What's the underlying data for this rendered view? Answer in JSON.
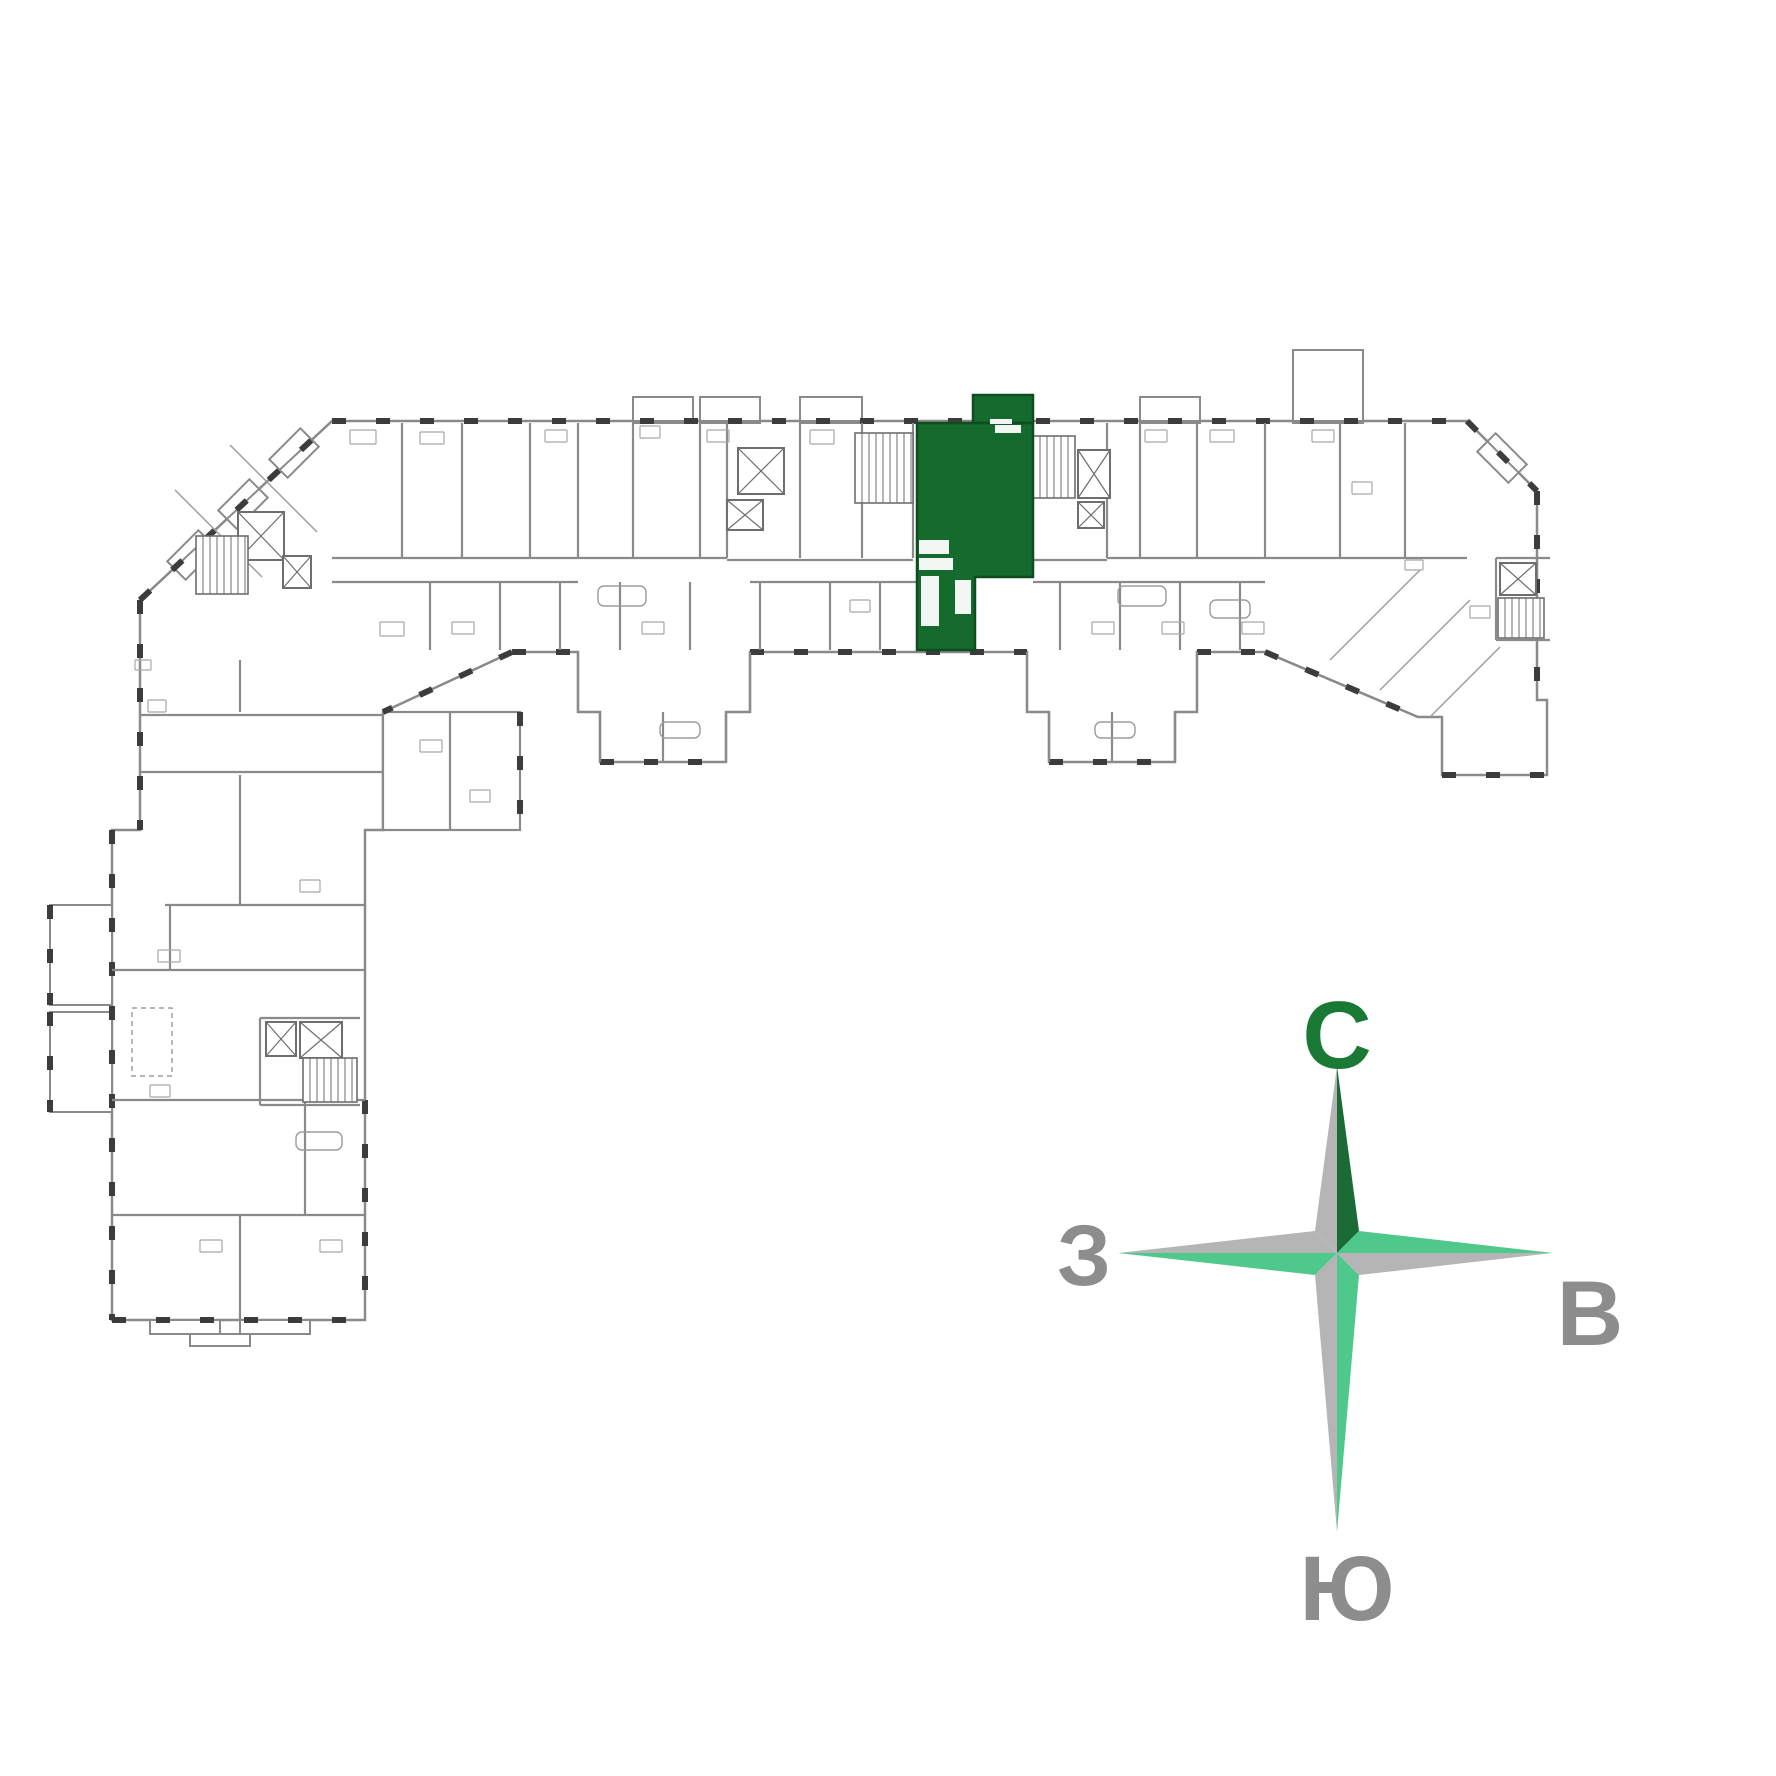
{
  "canvas": {
    "w": 1776,
    "h": 1776,
    "bg": "#ffffff"
  },
  "palette": {
    "wall": "#8a8a8a",
    "wall_dark": "#3c3c3c",
    "wall_mid": "#6e6e6e",
    "thin": "#9b9b9b",
    "fixture": "#a8a8a8",
    "green": "#156b2e",
    "green_stroke": "#0d4d20",
    "arm_gray": "#b5b5b5",
    "arm_green_dark": "#1a6b35",
    "arm_green_light": "#4fc98b",
    "text_gray": "#8d8d8d",
    "text_green": "#1a7a35"
  },
  "floorplan": {
    "outline": [
      [
        332,
        421
      ],
      [
        1467,
        421
      ],
      [
        1537,
        491
      ],
      [
        1537,
        700
      ],
      [
        1547,
        700
      ],
      [
        1547,
        775
      ],
      [
        1442,
        775
      ],
      [
        1442,
        717
      ],
      [
        1418,
        717
      ],
      [
        1265,
        652
      ],
      [
        1197,
        652
      ],
      [
        1197,
        712
      ],
      [
        1175,
        712
      ],
      [
        1175,
        762
      ],
      [
        1049,
        762
      ],
      [
        1049,
        712
      ],
      [
        1027,
        712
      ],
      [
        1027,
        652
      ],
      [
        750,
        652
      ],
      [
        750,
        712
      ],
      [
        726,
        712
      ],
      [
        726,
        762
      ],
      [
        600,
        762
      ],
      [
        600,
        712
      ],
      [
        578,
        712
      ],
      [
        578,
        652
      ],
      [
        512,
        652
      ],
      [
        383,
        712
      ],
      [
        383,
        830
      ],
      [
        365,
        830
      ],
      [
        365,
        1320
      ],
      [
        112,
        1320
      ],
      [
        112,
        830
      ],
      [
        140,
        830
      ],
      [
        140,
        600
      ]
    ],
    "attached_rooms": [
      [
        383,
        712,
        137,
        118
      ]
    ],
    "facade_walls": [
      [
        332,
        421,
        1467,
        421
      ],
      [
        1467,
        421,
        1537,
        491
      ],
      [
        1537,
        491,
        1537,
        700
      ],
      [
        1442,
        775,
        1547,
        775
      ],
      [
        512,
        652,
        578,
        652
      ],
      [
        750,
        652,
        1027,
        652
      ],
      [
        1197,
        652,
        1265,
        652
      ],
      [
        600,
        762,
        726,
        762
      ],
      [
        1049,
        762,
        1175,
        762
      ],
      [
        512,
        652,
        383,
        712
      ],
      [
        1265,
        652,
        1418,
        717
      ],
      [
        520,
        712,
        520,
        830
      ],
      [
        140,
        600,
        140,
        830
      ],
      [
        140,
        600,
        332,
        421
      ],
      [
        112,
        830,
        112,
        1320
      ],
      [
        112,
        1320,
        365,
        1320
      ],
      [
        365,
        1100,
        365,
        1320
      ],
      [
        50,
        905,
        50,
        1005
      ],
      [
        50,
        1012,
        50,
        1112
      ]
    ],
    "inner_walls": [
      [
        402,
        423,
        402,
        558
      ],
      [
        462,
        423,
        462,
        558
      ],
      [
        530,
        423,
        530,
        558
      ],
      [
        578,
        423,
        578,
        558
      ],
      [
        633,
        423,
        633,
        558
      ],
      [
        700,
        423,
        700,
        558
      ],
      [
        727,
        423,
        727,
        558
      ],
      [
        800,
        423,
        800,
        558
      ],
      [
        862,
        423,
        862,
        558
      ],
      [
        913,
        423,
        913,
        558
      ],
      [
        1107,
        423,
        1107,
        558
      ],
      [
        1140,
        423,
        1140,
        558
      ],
      [
        1197,
        423,
        1197,
        558
      ],
      [
        1265,
        423,
        1265,
        558
      ],
      [
        1340,
        423,
        1340,
        558
      ],
      [
        1405,
        423,
        1405,
        558
      ],
      [
        430,
        582,
        430,
        650
      ],
      [
        500,
        582,
        500,
        650
      ],
      [
        560,
        582,
        560,
        650
      ],
      [
        620,
        582,
        620,
        650
      ],
      [
        690,
        582,
        690,
        650
      ],
      [
        760,
        582,
        760,
        650
      ],
      [
        830,
        582,
        830,
        650
      ],
      [
        880,
        582,
        880,
        650
      ],
      [
        1060,
        582,
        1060,
        650
      ],
      [
        1120,
        582,
        1120,
        650
      ],
      [
        1180,
        582,
        1180,
        650
      ],
      [
        1240,
        582,
        1240,
        650
      ],
      [
        332,
        558,
        727,
        558
      ],
      [
        1107,
        558,
        1467,
        558
      ],
      [
        332,
        582,
        578,
        582
      ],
      [
        750,
        582,
        917,
        582
      ],
      [
        1033,
        582,
        1265,
        582
      ],
      [
        727,
        560,
        913,
        560
      ],
      [
        1033,
        560,
        1107,
        560
      ],
      [
        578,
        652,
        578,
        712
      ],
      [
        750,
        652,
        750,
        712
      ],
      [
        600,
        712,
        600,
        762
      ],
      [
        726,
        712,
        726,
        762
      ],
      [
        1027,
        652,
        1027,
        712
      ],
      [
        1197,
        652,
        1197,
        712
      ],
      [
        1049,
        712,
        1049,
        762
      ],
      [
        1175,
        712,
        1175,
        762
      ],
      [
        663,
        712,
        663,
        762
      ],
      [
        1112,
        712,
        1112,
        762
      ],
      [
        140,
        715,
        383,
        715
      ],
      [
        140,
        772,
        383,
        772
      ],
      [
        240,
        660,
        240,
        712
      ],
      [
        240,
        775,
        240,
        830
      ],
      [
        450,
        712,
        450,
        830
      ],
      [
        165,
        905,
        365,
        905
      ],
      [
        112,
        970,
        365,
        970
      ],
      [
        112,
        1100,
        365,
        1100
      ],
      [
        112,
        1215,
        365,
        1215
      ],
      [
        240,
        830,
        240,
        905
      ],
      [
        170,
        905,
        170,
        970
      ],
      [
        305,
        1100,
        305,
        1215
      ],
      [
        240,
        1215,
        240,
        1320
      ],
      [
        260,
        1018,
        360,
        1018
      ],
      [
        260,
        1018,
        260,
        1105
      ],
      [
        260,
        1105,
        360,
        1105
      ],
      [
        1496,
        558,
        1550,
        558
      ],
      [
        1496,
        558,
        1496,
        640
      ],
      [
        1496,
        640,
        1550,
        640
      ]
    ],
    "thin_walls": [
      [
        175,
        490,
        262,
        577
      ],
      [
        230,
        445,
        317,
        532
      ],
      [
        1330,
        660,
        1420,
        570
      ],
      [
        1380,
        690,
        1470,
        600
      ],
      [
        1430,
        717,
        1500,
        647
      ]
    ],
    "bays": [
      [
        633,
        397,
        60,
        26
      ],
      [
        700,
        397,
        60,
        26
      ],
      [
        800,
        397,
        62,
        26
      ],
      [
        1140,
        397,
        60,
        26
      ],
      [
        1293,
        350,
        70,
        73
      ],
      [
        150,
        1320,
        70,
        14
      ],
      [
        240,
        1320,
        70,
        14
      ],
      [
        190,
        1334,
        60,
        12
      ],
      [
        50,
        905,
        62,
        100
      ],
      [
        50,
        1012,
        62,
        100
      ]
    ],
    "rot_bays": [
      {
        "cx": 192,
        "cy": 555,
        "w": 44,
        "h": 26,
        "a": -45
      },
      {
        "cx": 243,
        "cy": 504,
        "w": 44,
        "h": 26,
        "a": -45
      },
      {
        "cx": 294,
        "cy": 453,
        "w": 44,
        "h": 26,
        "a": -45
      },
      {
        "cx": 1502,
        "cy": 458,
        "w": 44,
        "h": 26,
        "a": 45
      }
    ],
    "xboxes": [
      [
        738,
        448,
        46,
        46
      ],
      [
        727,
        500,
        36,
        30
      ],
      [
        1078,
        450,
        32,
        48
      ],
      [
        1078,
        502,
        26,
        26
      ],
      [
        238,
        512,
        46,
        48
      ],
      [
        283,
        556,
        28,
        32
      ],
      [
        1500,
        563,
        36,
        32
      ],
      [
        266,
        1022,
        30,
        34
      ],
      [
        300,
        1022,
        42,
        36
      ]
    ],
    "stairs": [
      [
        855,
        433,
        58,
        70
      ],
      [
        1033,
        436,
        42,
        62
      ],
      [
        196,
        536,
        52,
        58
      ],
      [
        1498,
        598,
        46,
        40
      ],
      [
        303,
        1058,
        54,
        44
      ]
    ],
    "fixtures": [
      [
        350,
        430,
        26,
        14
      ],
      [
        420,
        432,
        24,
        12
      ],
      [
        545,
        430,
        22,
        12
      ],
      [
        640,
        426,
        20,
        12
      ],
      [
        707,
        430,
        22,
        12
      ],
      [
        810,
        430,
        24,
        14
      ],
      [
        1145,
        430,
        22,
        12
      ],
      [
        1210,
        430,
        24,
        12
      ],
      [
        1312,
        430,
        22,
        12
      ],
      [
        380,
        622,
        24,
        14
      ],
      [
        452,
        622,
        22,
        12
      ],
      [
        642,
        622,
        22,
        12
      ],
      [
        850,
        600,
        20,
        12
      ],
      [
        1092,
        622,
        22,
        12
      ],
      [
        1162,
        622,
        22,
        12
      ],
      [
        1242,
        622,
        22,
        12
      ],
      [
        148,
        700,
        18,
        12
      ],
      [
        158,
        950,
        22,
        12
      ],
      [
        150,
        1085,
        20,
        12
      ],
      [
        300,
        880,
        20,
        12
      ],
      [
        1470,
        606,
        20,
        12
      ],
      [
        1352,
        482,
        20,
        12
      ],
      [
        420,
        740,
        22,
        12
      ],
      [
        470,
        790,
        20,
        12
      ],
      [
        200,
        1240,
        22,
        12
      ],
      [
        320,
        1240,
        22,
        12
      ],
      [
        135,
        660,
        16,
        10
      ],
      [
        1405,
        560,
        18,
        10
      ]
    ],
    "tubs": [
      [
        598,
        586,
        48,
        20
      ],
      [
        1118,
        586,
        48,
        20
      ],
      [
        296,
        1132,
        46,
        18
      ],
      [
        1210,
        600,
        40,
        18
      ],
      [
        660,
        722,
        40,
        16
      ],
      [
        1095,
        722,
        40,
        16
      ]
    ],
    "dashed_rects": [
      [
        132,
        1008,
        40,
        68
      ]
    ],
    "green_unit": {
      "outline": [
        [
          917,
          423
        ],
        [
          1033,
          423
        ],
        [
          1033,
          577
        ],
        [
          975,
          577
        ],
        [
          975,
          650
        ],
        [
          917,
          650
        ]
      ],
      "balcony": [
        973,
        395,
        60,
        28
      ],
      "white_fixtures": [
        [
          919,
          540,
          30,
          14
        ],
        [
          919,
          558,
          34,
          12
        ],
        [
          921,
          576,
          18,
          50
        ],
        [
          955,
          580,
          16,
          34
        ],
        [
          995,
          425,
          26,
          8
        ],
        [
          990,
          419,
          22,
          5
        ]
      ]
    }
  },
  "compass": {
    "cx": 1337,
    "cy": 1253,
    "half": 22,
    "tips": {
      "n": 1066,
      "s": 1532,
      "w": 1118,
      "e": 1553
    },
    "arm_colors": {
      "n_left": "arm_gray",
      "n_right": "arm_green_dark",
      "s_left": "arm_gray",
      "s_right": "arm_green_light",
      "w_top": "arm_gray",
      "w_bottom": "arm_green_light",
      "e_top": "arm_green_light",
      "e_bottom": "arm_gray"
    },
    "labels": {
      "north": {
        "text": "С",
        "x": 1337,
        "y": 1068,
        "size": 96,
        "color": "#1a7a35"
      },
      "south": {
        "text": "Ю",
        "x": 1347,
        "y": 1620,
        "size": 92,
        "color": "#8d8d8d"
      },
      "west": {
        "text": "З",
        "x": 1084,
        "y": 1285,
        "size": 86,
        "color": "#8d8d8d"
      },
      "east": {
        "text": "В",
        "x": 1590,
        "y": 1345,
        "size": 92,
        "color": "#8d8d8d"
      }
    }
  }
}
